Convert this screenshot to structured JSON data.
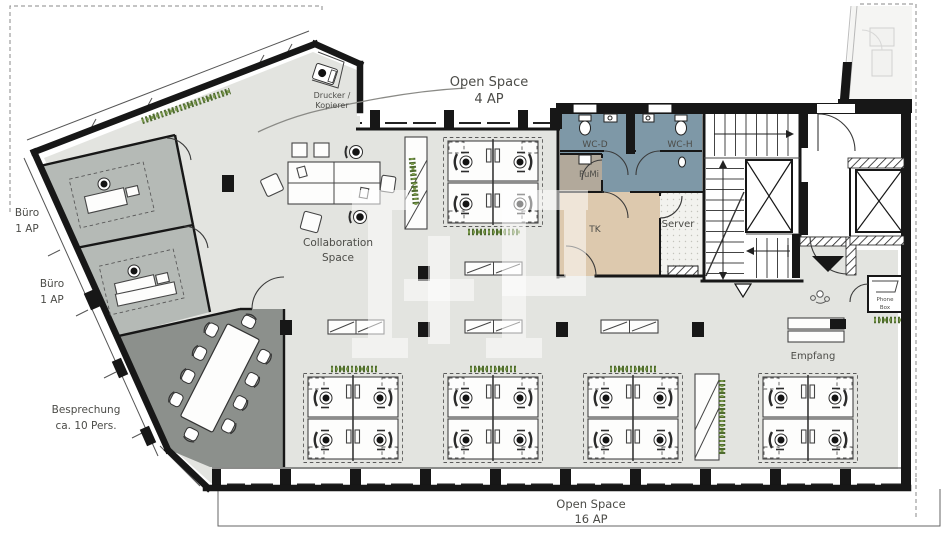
{
  "document": {
    "type": "architectural floor plan",
    "language": "de"
  },
  "colors": {
    "wall": "#171717",
    "open_space_floor": "#e3e4e0",
    "office_floor": "#b5bab6",
    "meeting_floor": "#8c908c",
    "wc_floor": "#7e98a7",
    "pumi_floor": "#b2a99b",
    "corridor_floor": "#ddc9ae",
    "server_floor": "#f2f2ee",
    "plant_dark": "#4f6b2f",
    "plant_light": "#7d9c4e",
    "label_text": "#4c4c48",
    "watermark": "rgba(255,255,255,0.52)"
  },
  "rooms": {
    "open_space_top": {
      "name": "Open Space",
      "capacity": "4 AP"
    },
    "open_space_main": {
      "name": "Open Space",
      "capacity": "16 AP"
    },
    "buero_1": {
      "name": "Büro",
      "capacity": "1 AP"
    },
    "buero_2": {
      "name": "Büro",
      "capacity": "1 AP"
    },
    "besprechung": {
      "name": "Besprechung",
      "capacity": "ca. 10 Pers."
    },
    "collaboration": {
      "name_line1": "Collaboration",
      "name_line2": "Space"
    },
    "empfang": {
      "name": "Empfang"
    },
    "wc_damen": {
      "name": "WC-D"
    },
    "wc_herren": {
      "name": "WC-H"
    },
    "pumi": {
      "name": "PuMi"
    },
    "tk": {
      "name": "TK"
    },
    "server": {
      "name": "Server"
    },
    "phone_box": {
      "name_line1": "Phone",
      "name_line2": "Box"
    },
    "drucker_kopierer": {
      "name_line1": "Drucker /",
      "name_line2": "Kopierer"
    }
  },
  "watermark": {
    "text": "I+P"
  }
}
